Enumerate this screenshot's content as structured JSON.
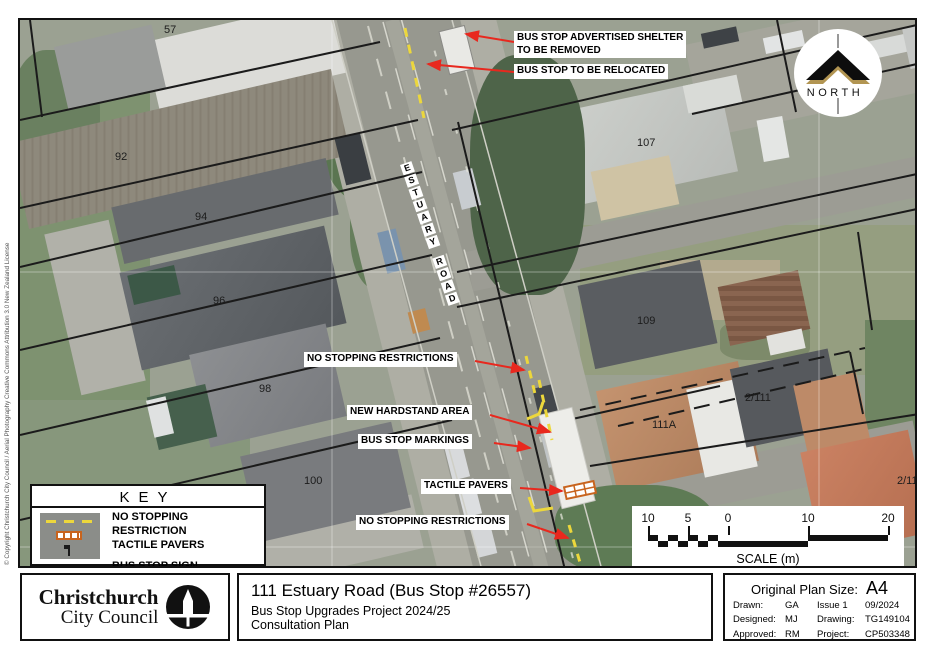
{
  "page": {
    "copyright": "© Copyright Christchurch City Council / Aerial Photography Creative Commons Attribution 3.0 New Zealand License"
  },
  "map": {
    "north_label": "NORTH",
    "road": {
      "name": "ESTUARY ROAD",
      "letters": [
        "E",
        "S",
        "T",
        "U",
        "A",
        "R",
        "Y",
        "R",
        "O",
        "A",
        "D"
      ]
    },
    "parcels": [
      "57",
      "92",
      "94",
      "96",
      "98",
      "100",
      "107",
      "109",
      "111A",
      "2/111",
      "2/11"
    ],
    "annotations": [
      {
        "text": "BUS STOP ADVERTISED SHELTER\nTO BE REMOVED"
      },
      {
        "text": "BUS STOP TO BE RELOCATED"
      },
      {
        "text": "NO STOPPING RESTRICTIONS"
      },
      {
        "text": "NEW HARDSTAND AREA"
      },
      {
        "text": "BUS STOP MARKINGS"
      },
      {
        "text": "TACTILE PAVERS"
      },
      {
        "text": "NO STOPPING RESTRICTIONS"
      }
    ]
  },
  "key": {
    "title": "KEY",
    "items": [
      "NO STOPPING RESTRICTION",
      "TACTILE PAVERS",
      "BUS STOP SIGN"
    ]
  },
  "scale": {
    "ticks": [
      "10",
      "5",
      "0",
      "10",
      "20"
    ],
    "label": "SCALE (m)"
  },
  "title_block": {
    "org_line1": "Christchurch",
    "org_line2": "City Council",
    "title": "111 Estuary Road (Bus Stop #26557)",
    "subtitle1": "Bus Stop Upgrades Project 2024/25",
    "subtitle2": "Consultation Plan"
  },
  "plan_info": {
    "size_label": "Original Plan Size:",
    "size": "A4",
    "rows": [
      {
        "l1": "Drawn:",
        "v1": "GA",
        "l2": "Issue 1",
        "v2": "09/2024"
      },
      {
        "l1": "Designed:",
        "v1": "MJ",
        "l2": "Drawing:",
        "v2": "TG149104"
      },
      {
        "l1": "Approved:",
        "v1": "RM",
        "l2": "Project:",
        "v2": "CP503348"
      }
    ]
  },
  "colors": {
    "annotation_arrow": "#e8281e",
    "no_stopping_marking": "#ecd73c",
    "tactile_paver": "#c8641e",
    "parcel_line": "#1b1b1b"
  }
}
